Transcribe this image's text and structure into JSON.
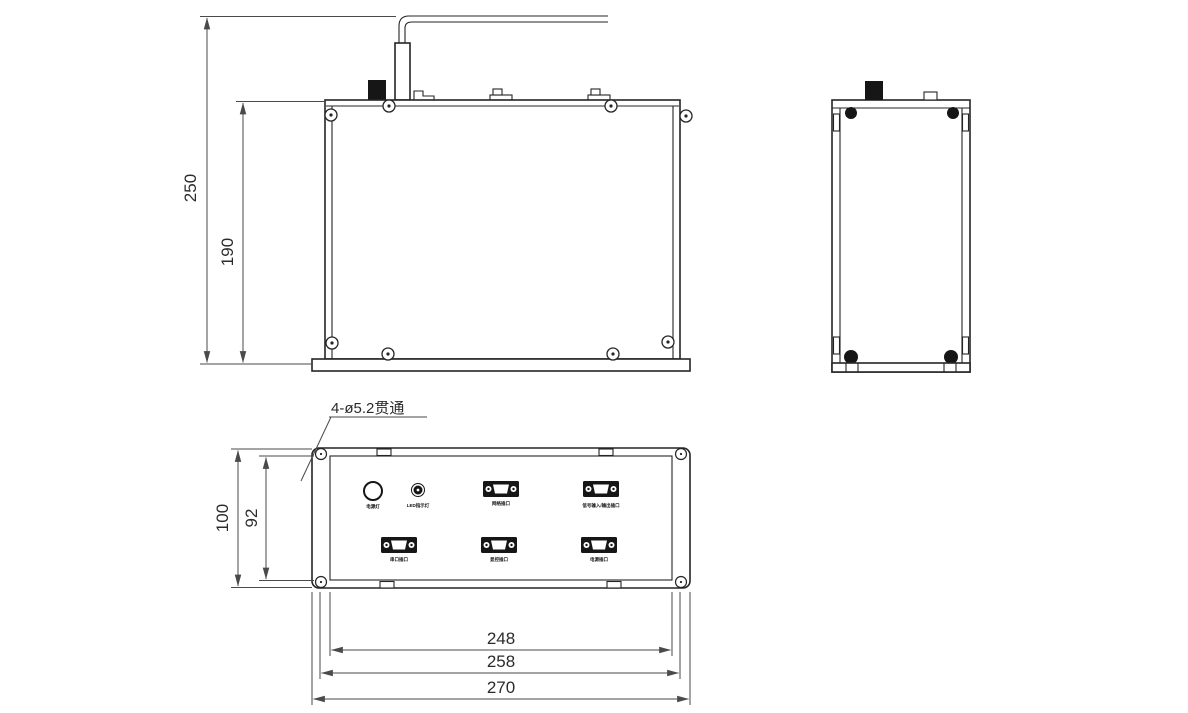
{
  "page": {
    "background": "#ffffff",
    "object_line_color": "#252525",
    "dimension_line_color": "#4a4a4a"
  },
  "annotation": {
    "hole_callout": "4-ø5.2贯通"
  },
  "front_view": {
    "dims": {
      "total_height": "250",
      "body_height": "190"
    }
  },
  "side_view": {},
  "bottom_view": {
    "dims": {
      "outer_height": "100",
      "inner_height": "92",
      "inner_width": "248",
      "mid_width": "258",
      "outer_width": "270"
    },
    "connectors": [
      {
        "type": "round-indicator",
        "label": "电源灯"
      },
      {
        "type": "led-indicator",
        "label": "LED指示灯"
      },
      {
        "type": "dsub",
        "label": "网络插口"
      },
      {
        "type": "dsub",
        "label": "信号输入/输出插口"
      },
      {
        "type": "dsub",
        "label": "串口插口"
      },
      {
        "type": "dsub",
        "label": "显控插口"
      },
      {
        "type": "dsub",
        "label": "电源插口"
      }
    ]
  }
}
